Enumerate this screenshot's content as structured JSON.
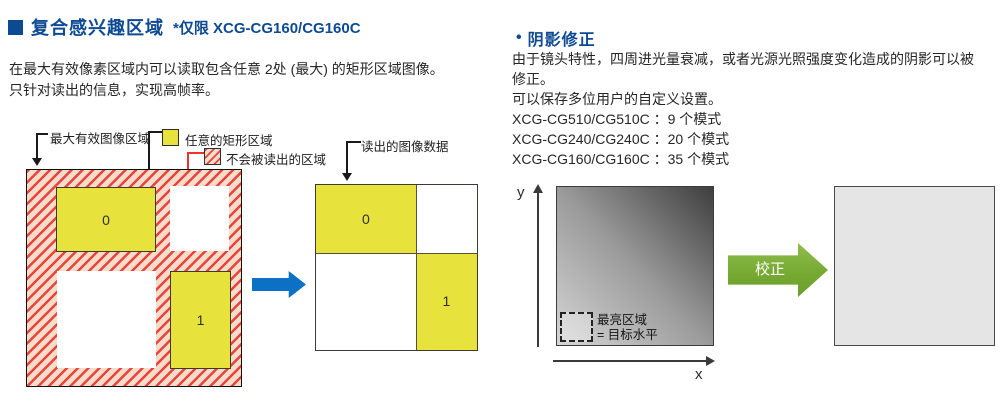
{
  "colors": {
    "heading_blue": "#0e4a93",
    "region_yellow": "#e7e33c",
    "hatch_pink": "#f8dccb",
    "hatch_red": "#e8443c",
    "flow_arrow_blue": "#0c70c4",
    "correction_green": "#76aa33",
    "shading_gradient_dark": "#3e3e3e",
    "shading_gradient_light": "#d6d6d6",
    "corrected_gray": "#e5e5e5"
  },
  "left_section": {
    "title": "复合感兴趣区域",
    "title_note": "*仅限 XCG-CG160/CG160C",
    "description_lines": [
      "在最大有效像素区域内可以读取包含任意 2处 (最大) 的矩形区域图像。",
      "只针对读出的信息，实现高帧率。"
    ],
    "legend": {
      "max_image_area": "最大有效图像区域",
      "arbitrary_rect_area": "任意的矩形区域",
      "not_read_area": "不会被读出的区域"
    },
    "source_diagram": {
      "region0": "0",
      "region1": "1"
    },
    "result_diagram": {
      "label": "读出的图像数据",
      "region0": "0",
      "region1": "1"
    }
  },
  "right_section": {
    "title": "阴影修正",
    "bullet": "•",
    "description_lines": [
      "由于镜头特性，四周进光量衰减，或者光源光照强度变化造成的阴影可以被",
      "修正。",
      "可以保存多位用户的自定义设置。",
      "XCG-CG510/CG510C ：9 个模式",
      "XCG-CG240/CG240C ：20 个模式",
      "XCG-CG160/CG160C ：35 个模式"
    ],
    "diagram": {
      "y_axis_label": "y",
      "x_axis_label": "x",
      "bright_area_line1": "最亮区域",
      "bright_area_line2": "= 目标水平",
      "correction_arrow_label": "校正"
    }
  }
}
